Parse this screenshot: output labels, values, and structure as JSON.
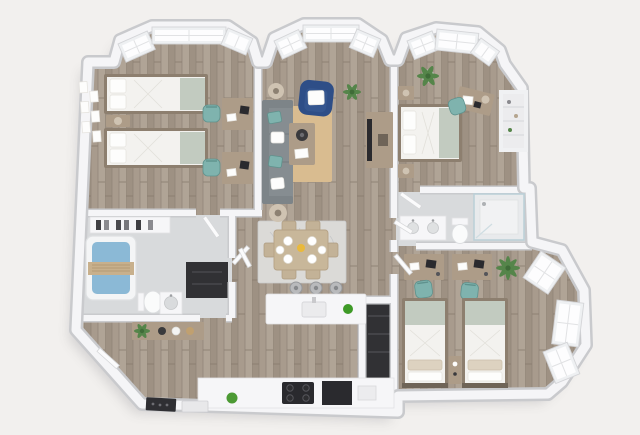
{
  "scene": {
    "type": "3d-floor-plan-render",
    "view": "isometric-top-down",
    "palette": {
      "background": "#f2f0ee",
      "wall": "#f5f5f7",
      "wall_edge": "#c9cacd",
      "floor_wood": "#a89b8d",
      "floor_seam": "#8f8376",
      "tile": "#d8dadc",
      "dark_interior": "#313134",
      "rug_tan": "#d9bc90",
      "rug_gray": "#dbdad7",
      "sofa_gray": "#868d91",
      "navy_armchair": "#2e4e87",
      "teal_chair": "#7fb3ae",
      "sage_green": "#c2cbc0",
      "linen_white": "#f3f2ef",
      "wood_furniture": "#8d7f6f",
      "tan_furniture": "#ad9c88",
      "lamp_beige": "#cfc3b2",
      "plant_green": "#55854a",
      "tub_water": "#8bb9d6",
      "appliance_black": "#2a2a2e",
      "window_pane": "#fdfdfe",
      "window_frame": "#eef0f2",
      "apple_green": "#3e9a27"
    }
  },
  "rooms": [
    {
      "name": "bedroom-top-left",
      "furniture": [
        "twin-bed",
        "twin-bed",
        "nightstand-with-lamp",
        "gallery-wall-frames",
        "desk",
        "desk",
        "teal-desk-chair",
        "teal-desk-chair",
        "bay-window"
      ]
    },
    {
      "name": "living-room",
      "furniture": [
        "gray-sofa",
        "teal-pillows",
        "navy-armchair",
        "white-pillow",
        "tan-area-rug",
        "coffee-table",
        "side-lamp",
        "side-lamp",
        "tv-console",
        "tv",
        "potted-plant",
        "bay-window"
      ]
    },
    {
      "name": "bedroom-top-right",
      "furniture": [
        "double-bed",
        "nightstand",
        "nightstand",
        "desk",
        "teal-desk-chair",
        "potted-plant",
        "closet-shelves",
        "bay-window"
      ]
    },
    {
      "name": "bathroom-left",
      "furniture": [
        "bathtub",
        "towel-caddy",
        "toilet",
        "sink",
        "storage-shelf",
        "dark-closet"
      ]
    },
    {
      "name": "hallway-entry",
      "furniture": [
        "console-table",
        "potted-plant",
        "decor-bowls",
        "entry-door"
      ]
    },
    {
      "name": "dining-area",
      "furniture": [
        "dining-table",
        "six-chairs",
        "six-plates",
        "yellow-pitcher",
        "gray-patterned-rug"
      ]
    },
    {
      "name": "kitchen",
      "furniture": [
        "island-with-sink",
        "three-bar-stools",
        "green-apple-decor",
        "counter",
        "cooktop",
        "black-appliance",
        "green-decor-ball"
      ]
    },
    {
      "name": "bathroom-right",
      "furniture": [
        "double-vanity",
        "toilet",
        "glass-shower"
      ]
    },
    {
      "name": "closet-dark",
      "furniture": [
        "shelves"
      ]
    },
    {
      "name": "bedroom-bottom-right",
      "furniture": [
        "twin-bed",
        "twin-bed",
        "nightstand-decor",
        "desk",
        "desk",
        "teal-desk-chair",
        "teal-desk-chair",
        "palm-plant",
        "bay-window-right"
      ]
    }
  ]
}
